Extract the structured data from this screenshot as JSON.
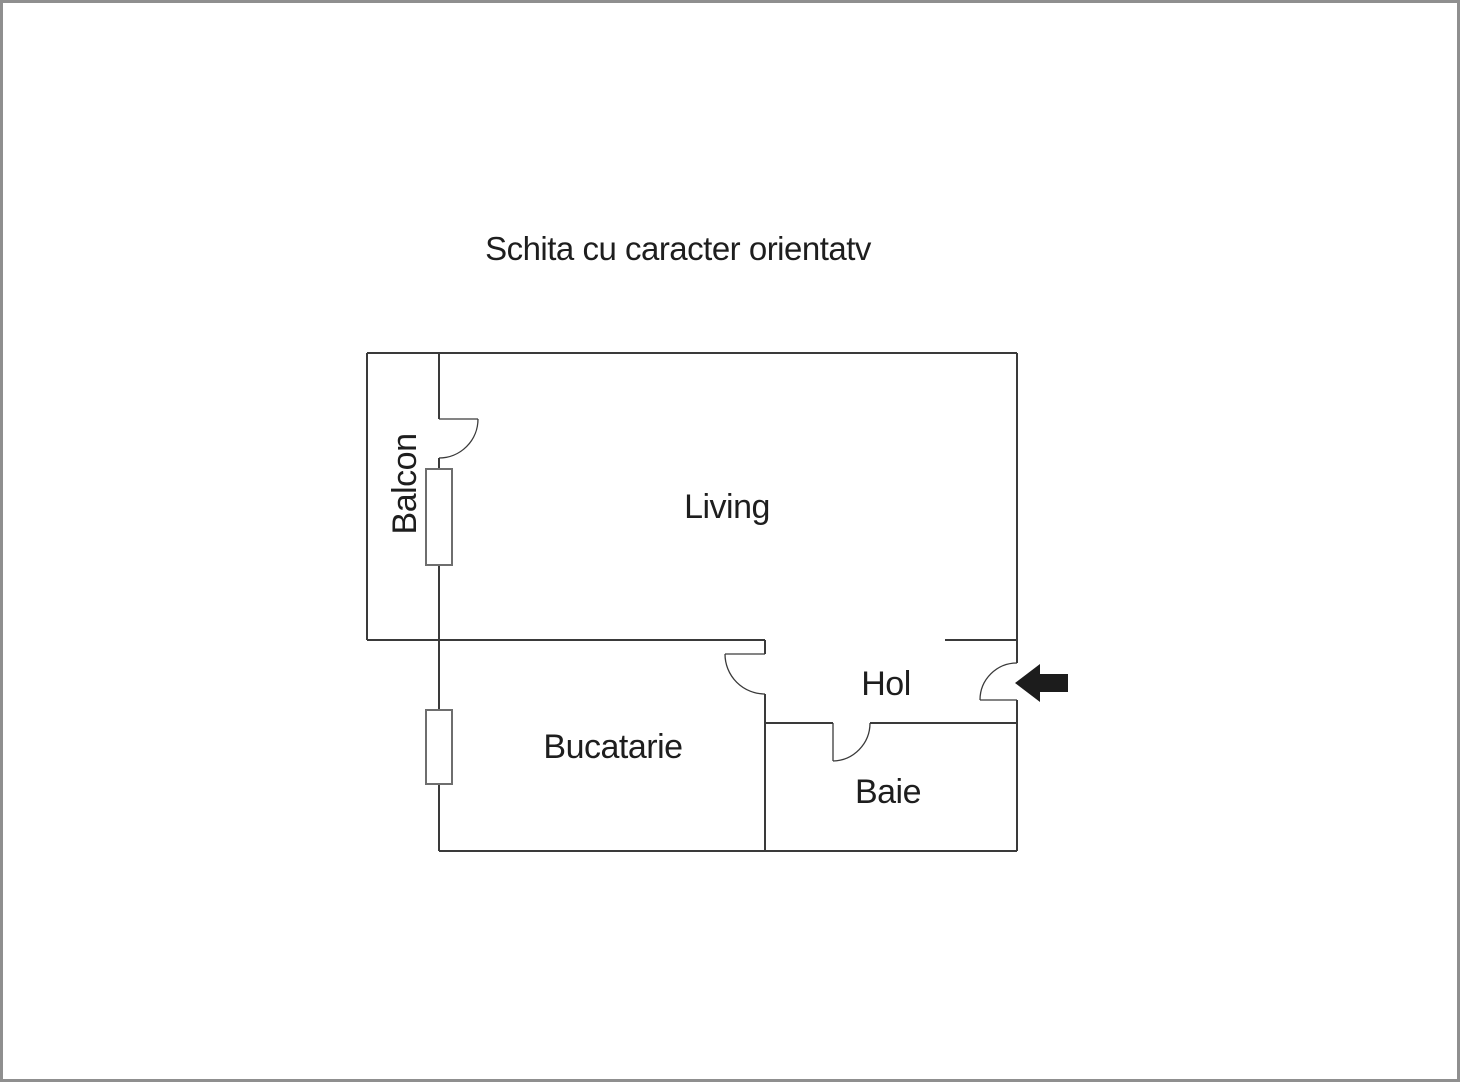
{
  "title": "Schita cu caracter orientatv",
  "floor_plan": {
    "rooms": {
      "balcon": {
        "label": "Balcon"
      },
      "living": {
        "label": "Living"
      },
      "hol": {
        "label": "Hol"
      },
      "bucatarie": {
        "label": "Bucatarie"
      },
      "baie": {
        "label": "Baie"
      }
    },
    "entrance": {
      "arrow_direction": "left"
    }
  },
  "colors": {
    "background": "#ffffff",
    "border": "#8f8f8f",
    "wall": "#3a3a3a",
    "window": "#6e6e6e",
    "text": "#1e1e1e",
    "arrow": "#1c1c1c"
  }
}
